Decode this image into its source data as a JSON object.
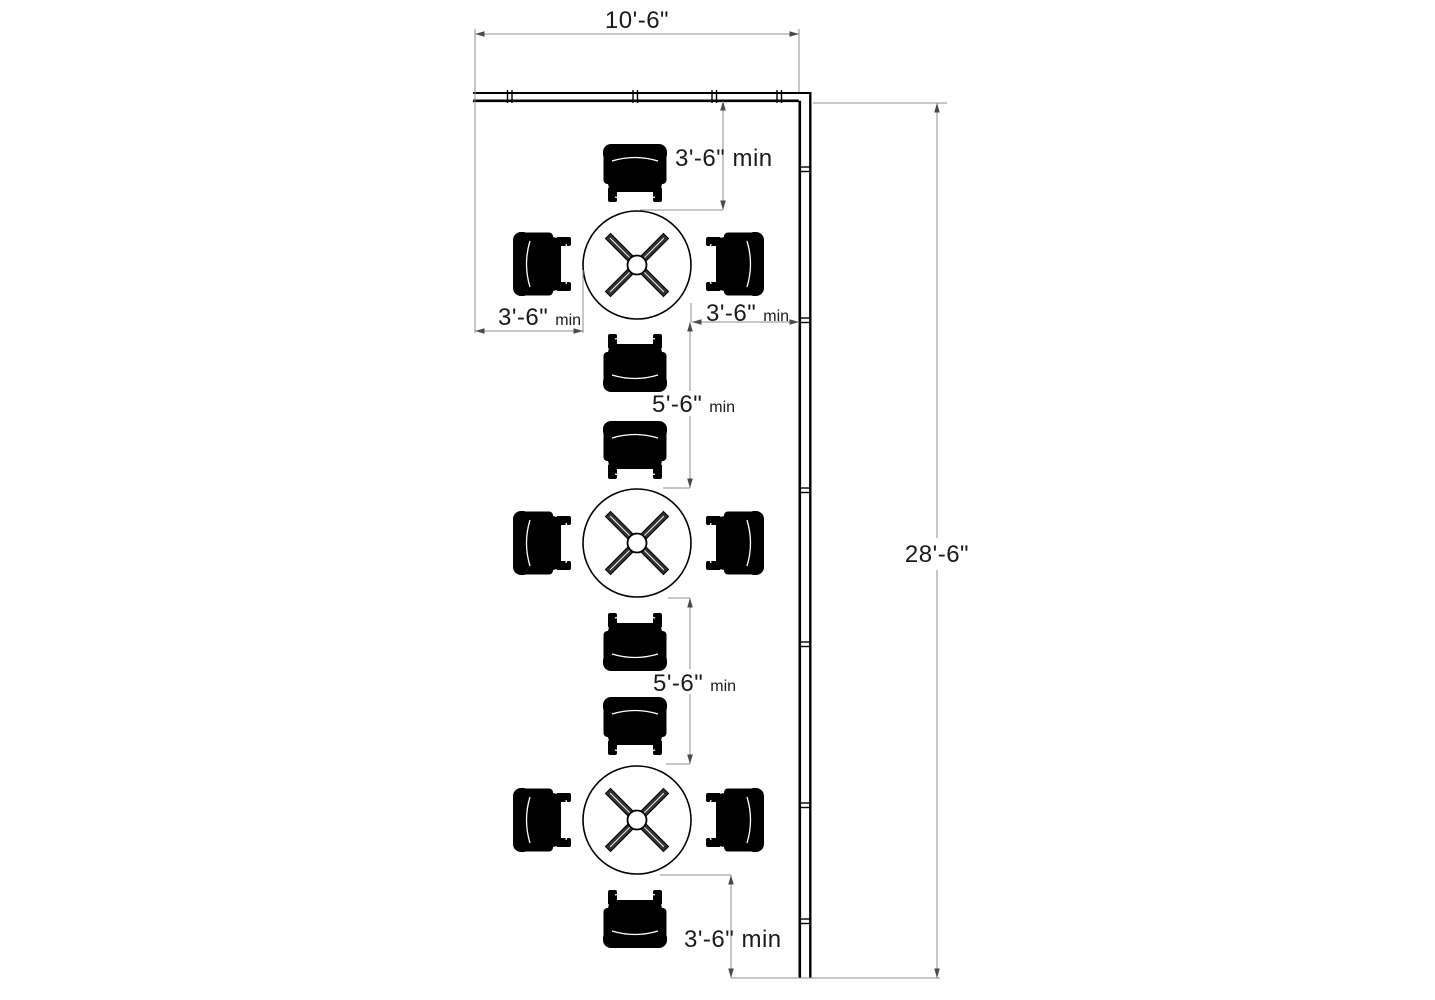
{
  "labels": {
    "top_width": "10'-6\"",
    "right_height": "28'-6\"",
    "top_clearance": "3'-6\" min",
    "bottom_clearance": "3'-6\" min",
    "left_clearance": {
      "value": "3'-6\"",
      "suffix": "min"
    },
    "right_clearance": {
      "value": "3'-6\"",
      "suffix": "min"
    },
    "aisle_upper": {
      "value": "5'-6\"",
      "suffix": "min"
    },
    "aisle_lower": {
      "value": "5'-6\"",
      "suffix": "min"
    }
  },
  "plan": {
    "table_count": 3,
    "chairs_per_table": 4
  },
  "colors": {
    "background": "#ffffff",
    "wall": "#000000",
    "furniture": "#000000",
    "dimension_line": "#8f8f8f",
    "text": "#1a1a1a"
  }
}
